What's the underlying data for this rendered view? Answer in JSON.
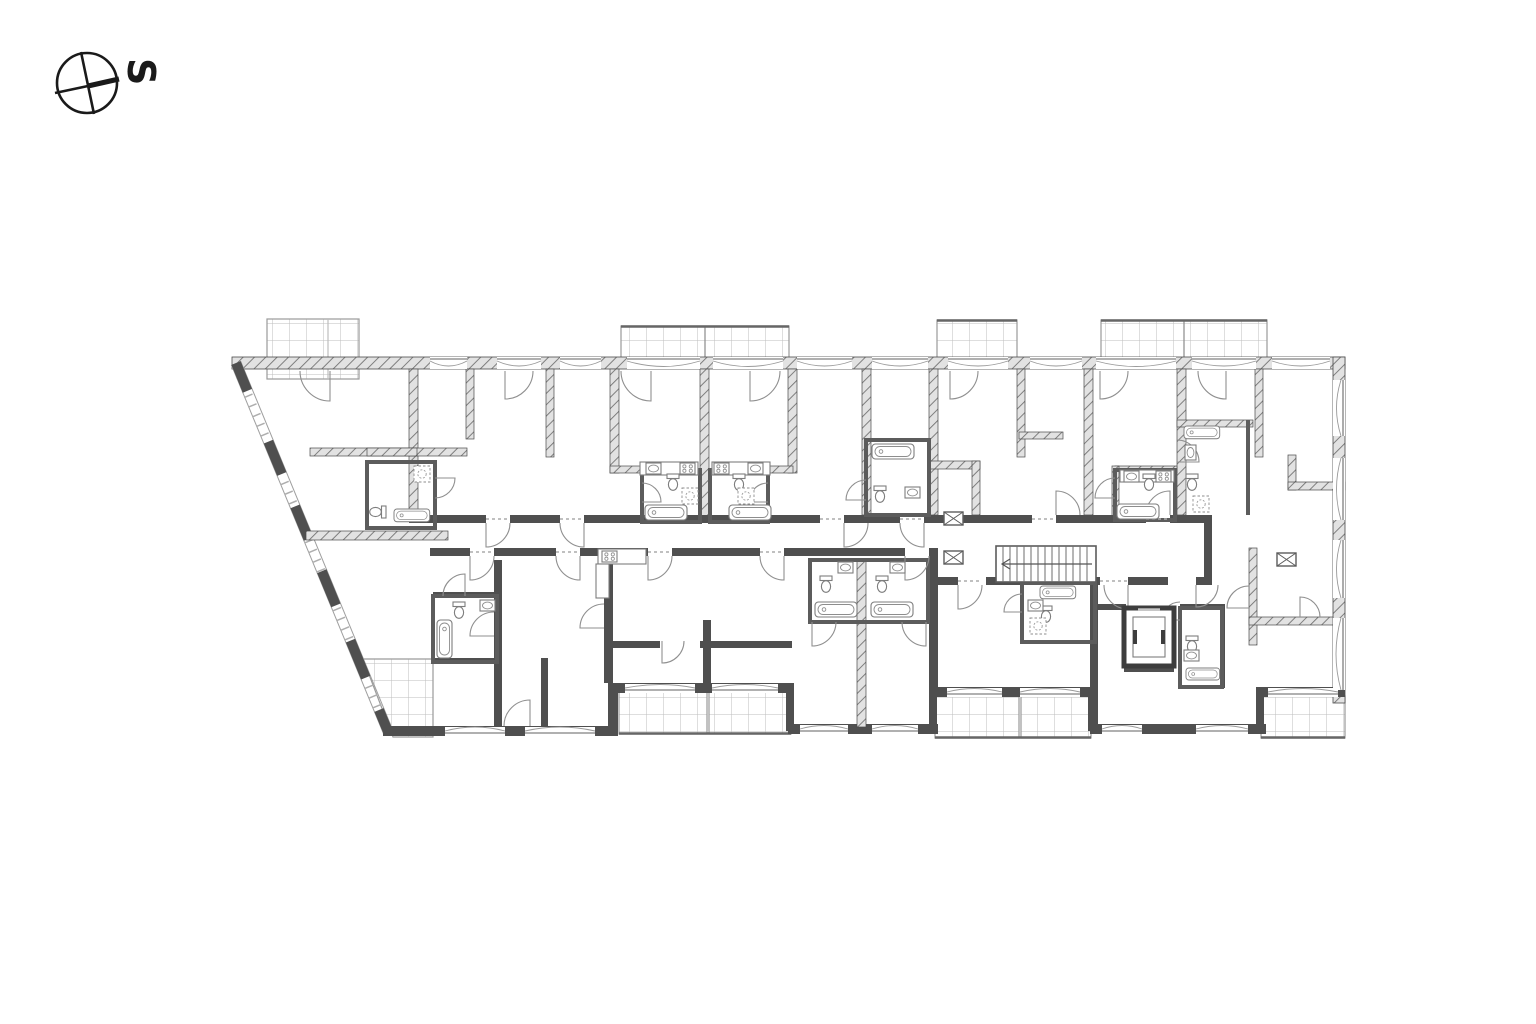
{
  "compass": {
    "label": "S",
    "direction": "south"
  },
  "palette": {
    "background": "#ffffff",
    "wall_solid": "#4f4f4f",
    "wall_hatch_bg": "#e2e2e2",
    "wall_hatch_line": "#737373",
    "thin_line": "#8f8f8f",
    "balcony_grid": "#bdbdbd",
    "ink": "#1a1a1a"
  },
  "plan": {
    "kind": "apartment-building-floor-plan",
    "balconies_top": 4,
    "balconies_bottom": 5,
    "terraces": 1,
    "has_staircase": true,
    "has_elevator": true
  }
}
